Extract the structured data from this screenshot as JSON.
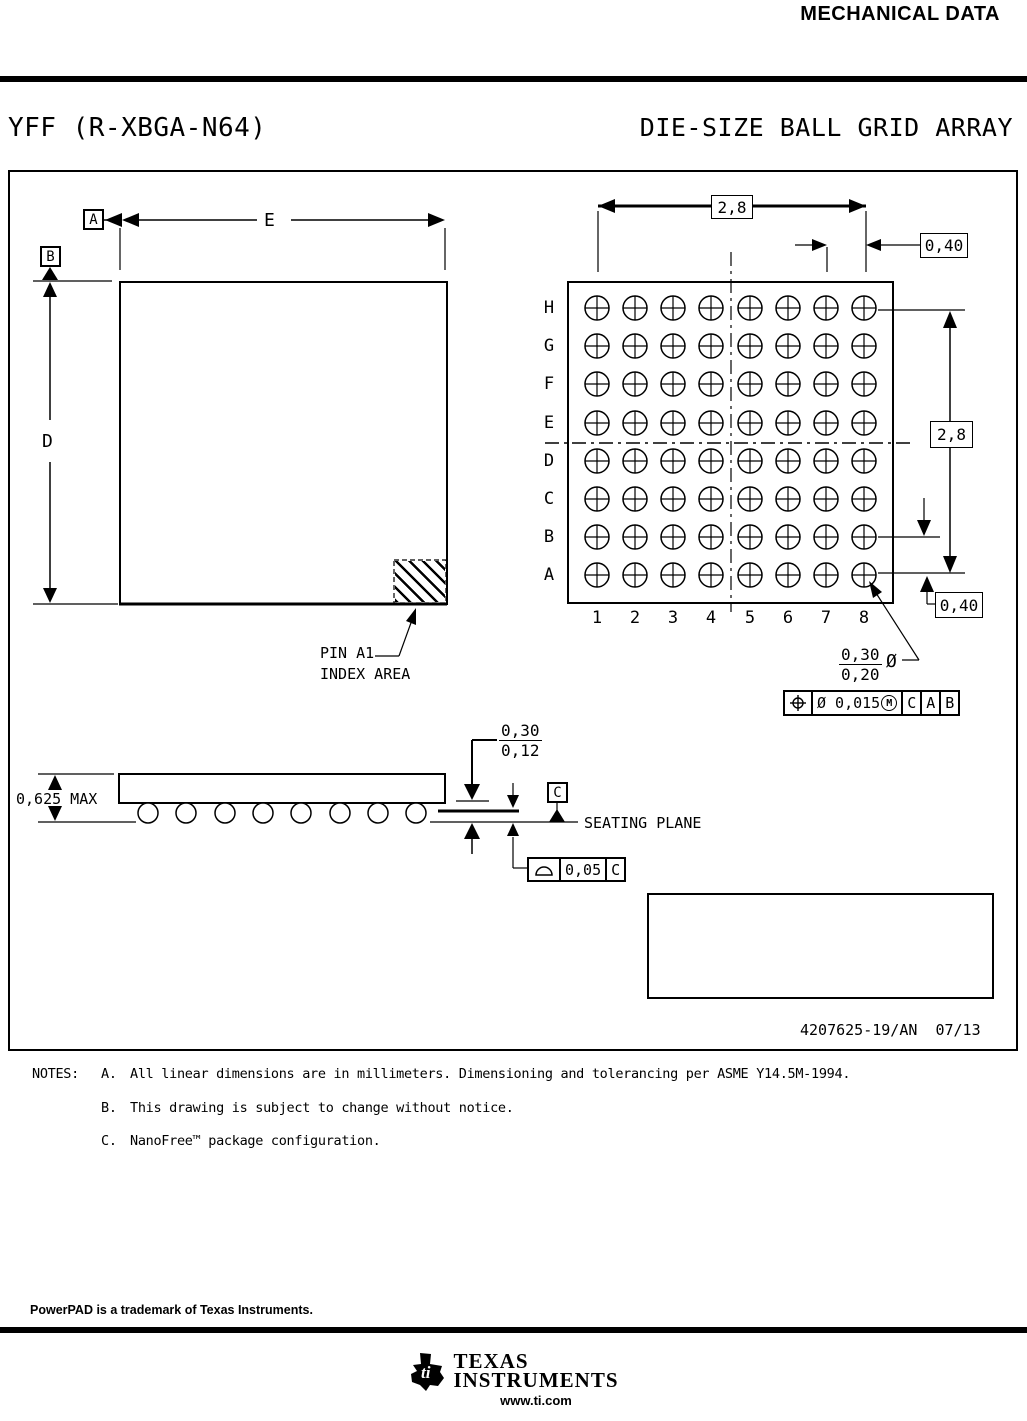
{
  "header": {
    "doc_title": "MECHANICAL DATA"
  },
  "title_row": {
    "package_code": "YFF (R-XBGA-N64)",
    "package_type": "DIE-SIZE BALL GRID ARRAY"
  },
  "plan_view": {
    "datum_a": "A",
    "datum_b": "B",
    "dim_width_label": "E",
    "dim_height_label": "D",
    "pin_a1_line1": "PIN A1",
    "pin_a1_line2": "INDEX AREA"
  },
  "ball_grid": {
    "row_labels": [
      "H",
      "G",
      "F",
      "E",
      "D",
      "C",
      "B",
      "A"
    ],
    "col_labels": [
      "1",
      "2",
      "3",
      "4",
      "5",
      "6",
      "7",
      "8"
    ],
    "dim_top": "2,8",
    "dim_right": "2,8",
    "pitch_top": "0,40",
    "pitch_right": "0,40",
    "ball_dia_upper": "0,30",
    "ball_dia_lower": "0,20",
    "diameter_symbol": "Ø",
    "fcf": {
      "tolerance": "Ø 0,015",
      "modifier": "M",
      "datum_1": "C",
      "datum_2": "A",
      "datum_3": "B"
    }
  },
  "side_view": {
    "height_max": "0,625 MAX",
    "standoff_upper": "0,30",
    "standoff_lower": "0,12",
    "datum_c": "C",
    "seating_plane_label": "SEATING PLANE",
    "flatness_value": "0,05",
    "flatness_datum": "C"
  },
  "title_block": {
    "drawing_number": "4207625-19/AN",
    "revision_date": "07/13"
  },
  "notes": {
    "label": "NOTES:",
    "items": [
      {
        "id": "A.",
        "text": "All linear dimensions are in millimeters.  Dimensioning and tolerancing per ASME Y14.5M-1994."
      },
      {
        "id": "B.",
        "text": "This drawing is subject to change without notice."
      },
      {
        "id": "C.",
        "text": "NanoFree™ package configuration."
      }
    ]
  },
  "footer": {
    "trademark": "PowerPAD is a trademark of Texas Instruments.",
    "logo_ti": "ti",
    "logo_line1": "Texas",
    "logo_line2": "Instruments",
    "website": "www.ti.com"
  },
  "colors": {
    "ink": "#000000",
    "paper": "#ffffff"
  }
}
